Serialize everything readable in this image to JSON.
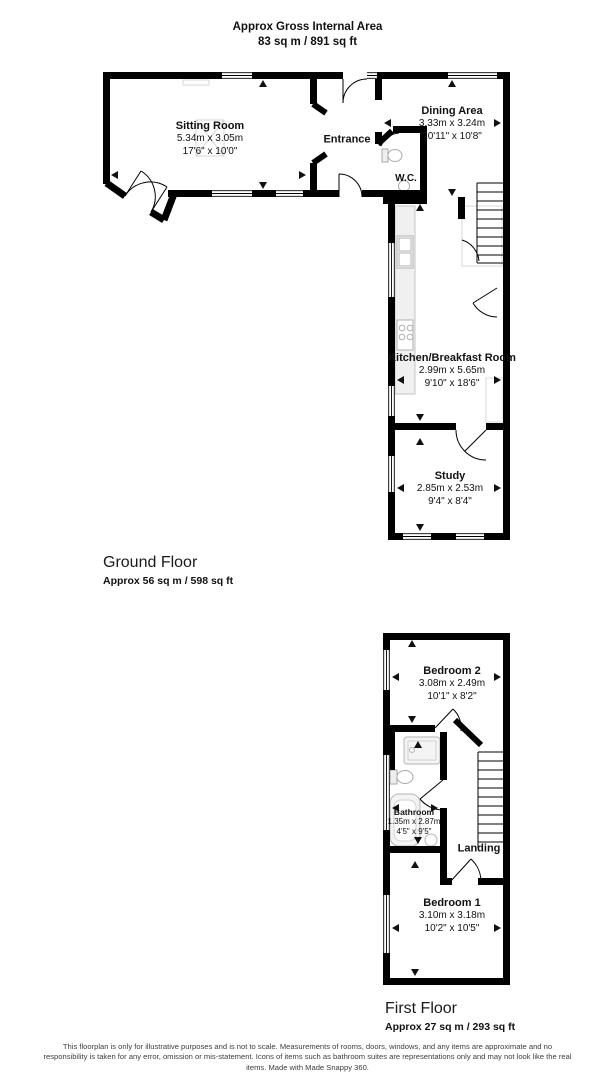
{
  "header": {
    "title": "Approx Gross Internal Area",
    "area": "83 sq m / 891 sq ft"
  },
  "floors": [
    {
      "name": "Ground Floor",
      "area_label": "Approx 56 sq m / 598 sq ft"
    },
    {
      "name": "First Floor",
      "area_label": "Approx 27 sq m / 293 sq ft"
    }
  ],
  "rooms": {
    "sitting_room": {
      "name": "Sitting Room",
      "metric": "5.34m x 3.05m",
      "imperial": "17'6\" x 10'0\""
    },
    "entrance": {
      "name": "Entrance"
    },
    "dining_area": {
      "name": "Dining Area",
      "metric": "3.33m x 3.24m",
      "imperial": "10'11\" x 10'8\""
    },
    "wc": {
      "name": "W.C."
    },
    "kitchen": {
      "name": "Kitchen/Breakfast Room",
      "metric": "2.99m x 5.65m",
      "imperial": "9'10\" x 18'6\""
    },
    "study": {
      "name": "Study",
      "metric": "2.85m x 2.53m",
      "imperial": "9'4\" x 8'4\""
    },
    "bedroom2": {
      "name": "Bedroom 2",
      "metric": "3.08m x 2.49m",
      "imperial": "10'1\" x 8'2\""
    },
    "bathroom": {
      "name": "Bathroom",
      "metric": "1.35m x 2.87m",
      "imperial": "4'5\" x 9'5\""
    },
    "landing": {
      "name": "Landing"
    },
    "bedroom1": {
      "name": "Bedroom 1",
      "metric": "3.10m x 3.18m",
      "imperial": "10'2\" x 10'5\""
    }
  },
  "disclaimer": "This floorplan is only for illustrative purposes and is not to scale. Measurements of rooms, doors, windows, and any items are approximate and no responsibility is taken for any error, omission or mis-statement. Icons of items such as bathroom suites are representations only and may not look like the real items. Made with Made Snappy 360.",
  "colors": {
    "wall": "#000000",
    "fixture": "#b5b5b5",
    "background": "#ffffff"
  }
}
